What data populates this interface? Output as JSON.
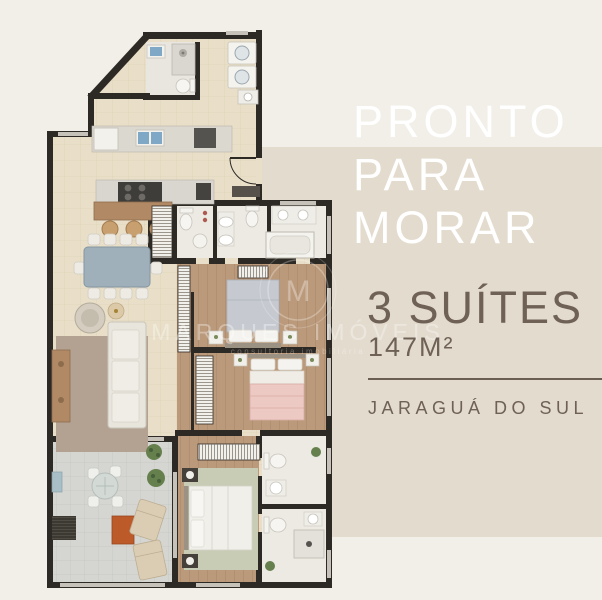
{
  "page": {
    "background_color": "#f2efe8",
    "panel_color": "#e3dbce",
    "headline_color": "#ffffff",
    "text_color": "#6f6156"
  },
  "headline": {
    "line1": "PRONTO",
    "line2": "PARA",
    "line3": "MORAR"
  },
  "details": {
    "suites": "3 SUÍTES",
    "area": "147M²",
    "location": "JARAGUÁ DO SUL"
  },
  "watermark": {
    "monogram": "M",
    "name": "MARQUES IMÓVEIS",
    "tagline": "consultoria imobiliária"
  },
  "floor_plan": {
    "description": "Planta do apartamento de 3 suítes com 147 m²: cozinha, lavabo e lavanderia no topo, sala de jantar e estar, varanda com lounge, três suítes com banheiros",
    "colors": {
      "wall": "#2d2925",
      "tile_floor": "#e9dfc8",
      "wood_floor": "#bb9a7b",
      "bath_floor": "#eceae3",
      "balcony_floor": "#d5d6d2",
      "sofa": "#e8e5dd",
      "dining_table": "#9fb0ba",
      "bed_suite1": "#c6cad0",
      "bed_suite2": "#edc9c3",
      "bed_suite3": "#f0efe9",
      "accent_table": "#bd5a2a",
      "plants": "#66804d",
      "sink_blue": "#7fa8c6",
      "counter_wood": "#b18a65"
    }
  }
}
